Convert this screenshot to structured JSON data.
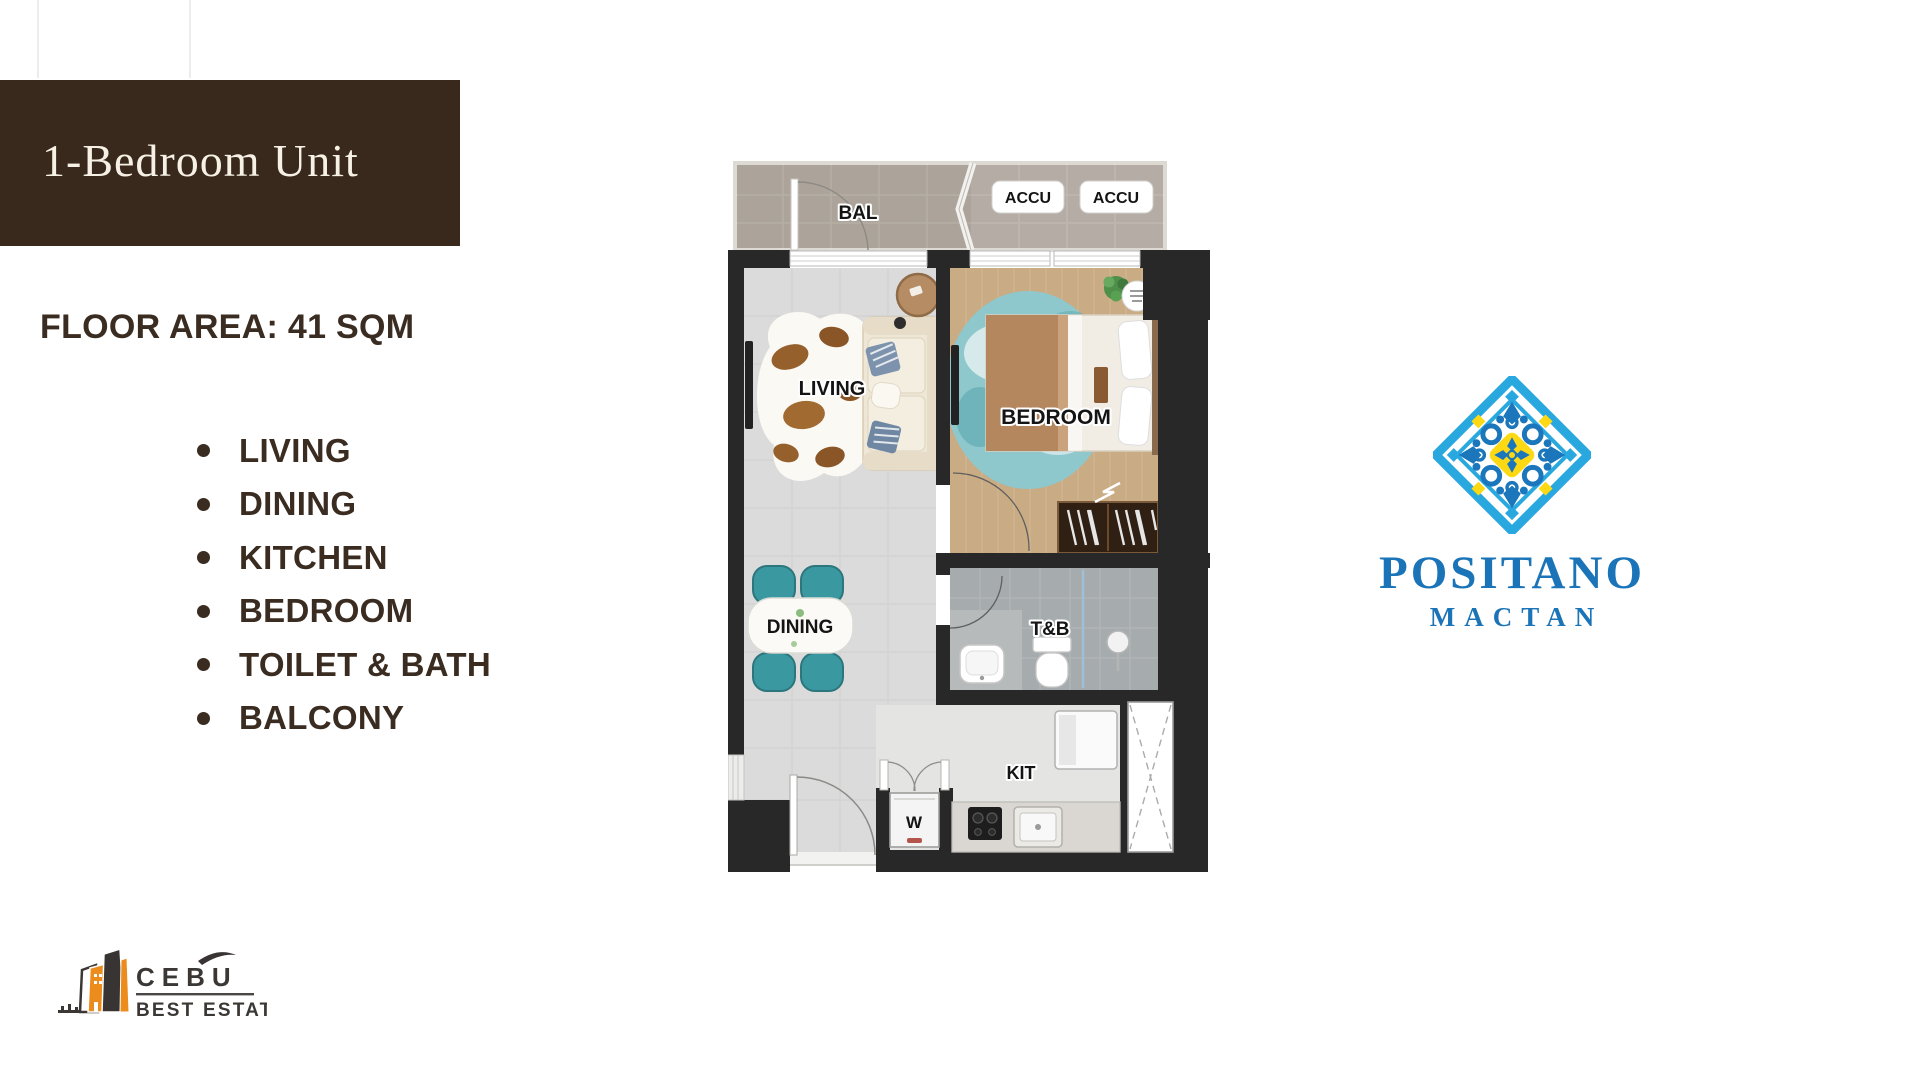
{
  "slide": {
    "background": "#ffffff"
  },
  "title_banner": {
    "label": "1-Bedroom Unit"
  },
  "specs": {
    "floor_area_label": "FLOOR AREA: 41 SQM",
    "features": [
      "LIVING",
      "DINING",
      "KITCHEN",
      "BEDROOM",
      "TOILET & BATH",
      "BALCONY"
    ]
  },
  "floorplan": {
    "labels": {
      "balcony": "BAL",
      "accu_left": "ACCU",
      "accu_right": "ACCU",
      "living": "LIVING",
      "bedroom": "BEDROOM",
      "dining": "DINING",
      "toilet_bath": "T&B",
      "kitchen": "KIT",
      "washer": "W"
    }
  },
  "positano_logo": {
    "name": "POSITANO",
    "location": "MACTAN",
    "colors": {
      "blue": "#1b74b8",
      "light_blue": "#29a8e0",
      "yellow": "#fdd913"
    }
  },
  "cebu_logo": {
    "name": "CEBU",
    "tagline": "BEST ESTATE",
    "colors": {
      "orange": "#ec8c1c",
      "dark": "#3b3734"
    }
  }
}
